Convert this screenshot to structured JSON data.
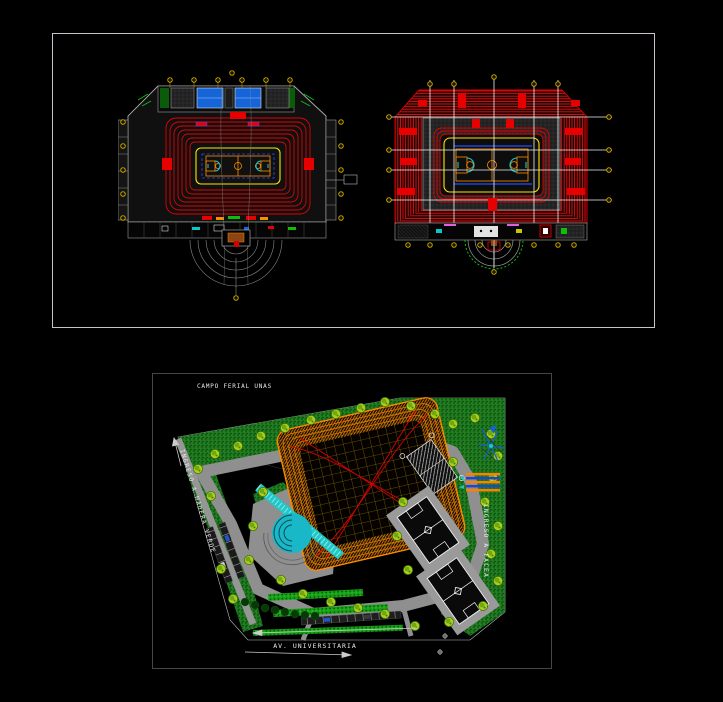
{
  "window": {
    "background": "#000000",
    "description": "CAD drawing viewer, black model space with two plan sheets"
  },
  "sheets": {
    "top": {
      "name": "coliseum-floor-plans-sheet"
    },
    "bottom": {
      "name": "site-plan-sheet"
    }
  },
  "site": {
    "label_top": "CAMPO FERIAL UNAS",
    "label_left": "INGRESO A MADERA VERDE",
    "label_right": "INGRESO A FACEA",
    "label_bottom": "AV. UNIVERSITARIA"
  },
  "palette": {
    "seating_red": "#e60000",
    "boundary_yellow": "#ffe400",
    "court_orange": "#ff8c00",
    "roof_orange": "#e07800",
    "pool_blue": "#1565d8",
    "court_line_blue": "#2050ff",
    "stair_cyan": "#19c8c8",
    "grass_green": "#1e7a1e",
    "tree_green": "#a8d018",
    "road_gray": "#8f8f8f",
    "sheet_border": "#c9c2cc",
    "grid_bubble_gold": "#c8a400",
    "white": "#ffffff"
  }
}
